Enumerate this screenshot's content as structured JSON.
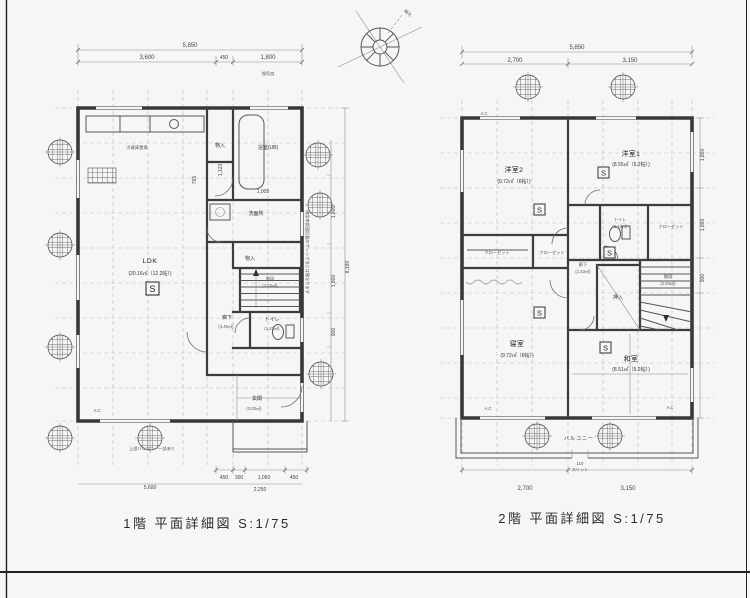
{
  "sheet": {
    "caption_floor1": "1階 平面詳細図 S:1/75",
    "caption_floor2": "2階 平面詳細図 S:1/75",
    "compass_label": "磁北"
  },
  "floor1": {
    "rooms": {
      "ldk_name": "LDK",
      "ldk_area": "(20.16㎡（12.2帖）)",
      "monoire_top": "物入",
      "bath": "浴室(UB)",
      "senmenjo": "洗面所",
      "monoire_mid": "物入",
      "stairs_name": "階段",
      "stairs_area": "(2.63㎡)",
      "rouka_name": "廊下",
      "rouka_area": "(4.46㎡)",
      "toilet_name": "トイレ",
      "toilet_area": "(1.22㎡)",
      "genkan_name": "玄関",
      "genkan_area": "(2.03㎡)",
      "fridge": "冷蔵庫置場"
    },
    "dims": {
      "top_total": "5,850",
      "top_seg1": "3,600",
      "top_seg2": "450",
      "top_seg3": "1,800",
      "top_note": "換気扇",
      "inner_a": "1,005",
      "inner_b": "1,123",
      "inner_c": "765",
      "right_1": "1,800",
      "right_2": "1,800",
      "right_3": "900",
      "right_total": "8,190",
      "bottom_1": "450",
      "bottom_2": "300",
      "bottom_3": "1,050",
      "bottom_4": "450",
      "bottom_sub": "2,250",
      "bottom_left": "5,600"
    },
    "notes": {
      "balcony_over": "上部バルコニー一部あり",
      "sash": "確認申請図記載のサッシ寸法とは異なります",
      "ac": "A.C"
    },
    "s_mark": "S"
  },
  "floor2": {
    "rooms": {
      "yoshitsu2_name": "洋室2",
      "yoshitsu2_area": "(9.72㎡（6帖）)",
      "yoshitsu1_name": "洋室1",
      "yoshitsu1_area": "(8.55㎡（5.2帖）)",
      "toilet_name": "トイレ",
      "toilet_area": "(1.22㎡)",
      "closet_right": "クローゼット",
      "closet_1": "クローゼット",
      "closet_2": "クローゼット",
      "rouka_name": "廊下",
      "rouka_area": "(1.43㎡)",
      "oshiire": "押入",
      "stairs_name": "階段",
      "stairs_area": "(2.63㎡)",
      "shinshitsu_name": "寝室",
      "shinshitsu_area": "(9.72㎡（6帖）)",
      "washitsu_name": "和室",
      "washitsu_area": "(8.51㎡（5.2帖）)",
      "balcony": "バルコニー"
    },
    "dims": {
      "top_total": "5,850",
      "top_seg1": "2,700",
      "top_seg2": "3,150",
      "bottom_1": "2,700",
      "bottom_2": "3,150",
      "slit_num": "110",
      "slit_label": "スリット",
      "right_1": "1,800",
      "right_2": "1,800",
      "right_3": "900"
    },
    "notes": {
      "ac": "A.C"
    },
    "s_mark": "S"
  }
}
